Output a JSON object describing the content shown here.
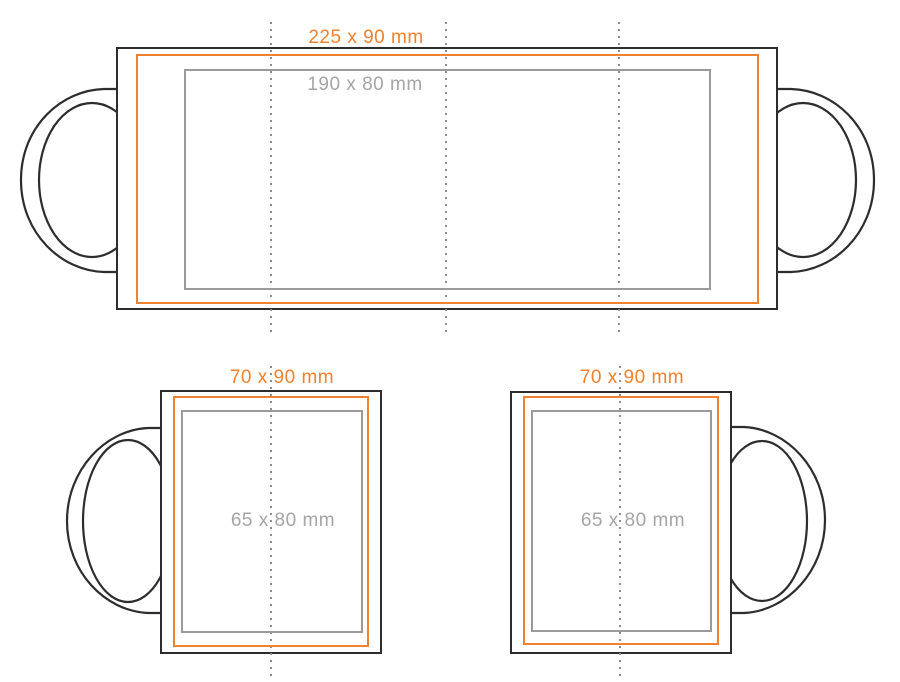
{
  "colors": {
    "background": "#ffffff",
    "outline": "#2d2d2d",
    "template": "#f0812f",
    "print_area": "#9a9a9a",
    "print_label": "#a5a5a5",
    "guide": "#8d8d8d"
  },
  "views": {
    "wrap": {
      "template_size": "225 x 90 mm",
      "print_size": "190 x 80 mm"
    },
    "mug_handle_left": {
      "template_size": "70 x 90 mm",
      "print_size": "65 x 80 mm"
    },
    "mug_handle_right": {
      "template_size": "70 x 90 mm",
      "print_size": "65 x 80 mm"
    }
  }
}
